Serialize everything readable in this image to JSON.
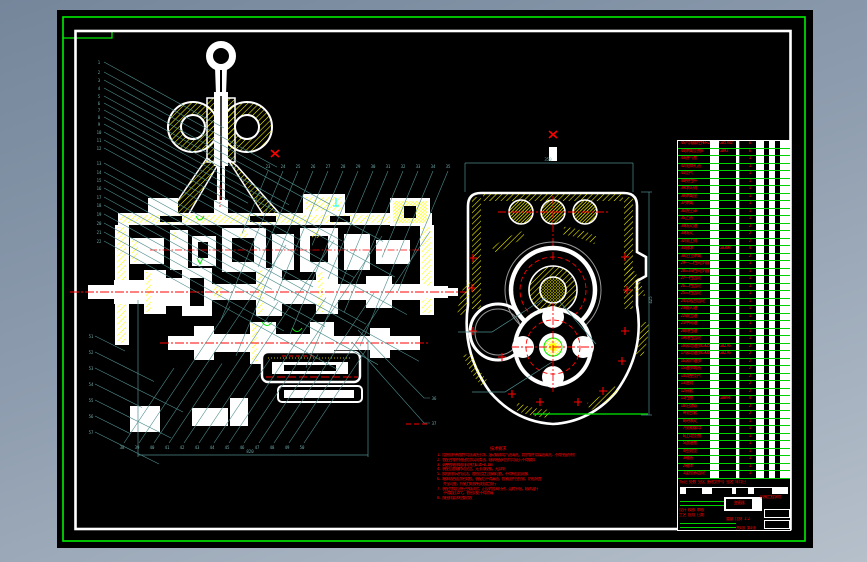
{
  "window": {
    "app": "CAD drawing viewport"
  },
  "colors": {
    "canvas": "#000000",
    "frame_green": "#00ff00",
    "sheet_white": "#ffffff",
    "hatch_yellow": "#ffff00",
    "centerline_red": "#ff0000",
    "leader_teal": "#4f8d8d",
    "table_green": "#00d200",
    "text_red": "#ff0000",
    "margin_gray": "#8d9cae"
  },
  "balloons": {
    "left": [
      "1",
      "2",
      "3",
      "4",
      "5",
      "6",
      "7",
      "8",
      "9",
      "10",
      "11",
      "12",
      "13",
      "14",
      "15",
      "16",
      "17",
      "18",
      "19",
      "20",
      "21",
      "22"
    ],
    "top": [
      "23",
      "24",
      "25",
      "26",
      "27",
      "28",
      "29",
      "30",
      "31",
      "32",
      "33",
      "34",
      "35"
    ],
    "right": [
      "36",
      "37"
    ],
    "bottom": [
      "38",
      "39",
      "40",
      "41",
      "42",
      "43",
      "44",
      "45",
      "46",
      "47",
      "48",
      "49",
      "50"
    ],
    "left_lower": [
      "51",
      "52",
      "53",
      "54",
      "55",
      "56",
      "57"
    ]
  },
  "dimensions": {
    "overall": "820",
    "top_width": "350",
    "side_height": "425"
  },
  "notes": {
    "title": "技术要求",
    "items": [
      {
        "text": "1. 组装前所有零件均须清洗干净，滚动轴承用汽油清洗，其余零件用煤油清洗，不得残留杂物",
        "indent": false
      },
      {
        "text": "2. 各配合零件装配前涂以润滑油，轴承装配时应均匀敲入不得偏斜",
        "indent": false
      },
      {
        "text": "3. 调整各轴承轴向间隙为0.05~0.1mm",
        "indent": false
      },
      {
        "text": "4. 装配后各轴转动灵活，无卡滞现象，无异响",
        "indent": false
      },
      {
        "text": "5. 换挡机构动作灵活，各档位定位准确可靠，不得有乱档现象",
        "indent": false
      },
      {
        "text": "6. 箱体结合面涂密封胶，装配后不得漏油，各紧固件应拧紧，防松装置",
        "indent": false
      },
      {
        "text": "齐全可靠，拧紧力矩按有关规定执行",
        "indent": true
      },
      {
        "text": "7. 装配完成后进行空载试验，正反转各30分钟，运转平稳，轴承温升",
        "indent": false
      },
      {
        "text": "不得超过35℃，各密封处不得渗漏",
        "indent": true
      },
      {
        "text": "8. 按图样要求检查验收",
        "indent": false
      }
    ]
  },
  "bom": {
    "rows": [
      {
        "no": "45",
        "name": "六角螺栓M8×25",
        "code": "GB5782",
        "qty": "6"
      },
      {
        "no": "44",
        "name": "弹簧垫圈8",
        "code": "GB93",
        "qty": "6"
      },
      {
        "no": "43",
        "name": "通气塞",
        "code": "",
        "qty": "1"
      },
      {
        "no": "42",
        "name": "观察孔盖",
        "code": "",
        "qty": "1"
      },
      {
        "no": "41",
        "name": "垫片",
        "code": "",
        "qty": "1"
      },
      {
        "no": "40",
        "name": "换挡杆",
        "code": "",
        "qty": "1"
      },
      {
        "no": "39",
        "name": "球头销",
        "code": "",
        "qty": "1"
      },
      {
        "no": "38",
        "name": "弹簧座",
        "code": "",
        "qty": "1"
      },
      {
        "no": "37",
        "name": "弹簧",
        "code": "",
        "qty": "1"
      },
      {
        "no": "36",
        "name": "防尘罩",
        "code": "",
        "qty": "1"
      },
      {
        "no": "35",
        "name": "上盖",
        "code": "",
        "qty": "1"
      },
      {
        "no": "34",
        "name": "拨叉轴",
        "code": "",
        "qty": "2"
      },
      {
        "no": "33",
        "name": "拨叉",
        "code": "",
        "qty": "2"
      },
      {
        "no": "32",
        "name": "锁止销",
        "code": "",
        "qty": "2"
      },
      {
        "no": "31",
        "name": "钢球",
        "code": "GB308",
        "qty": "4"
      },
      {
        "no": "30",
        "name": "定位弹簧",
        "code": "",
        "qty": "2"
      },
      {
        "no": "29",
        "name": "一二档同步器",
        "code": "",
        "qty": "1"
      },
      {
        "no": "28",
        "name": "三四档同步器",
        "code": "",
        "qty": "1"
      },
      {
        "no": "27",
        "name": "一档齿轮",
        "code": "",
        "qty": "1"
      },
      {
        "no": "26",
        "name": "二档齿轮",
        "code": "",
        "qty": "1"
      },
      {
        "no": "25",
        "name": "三档齿轮",
        "code": "",
        "qty": "1"
      },
      {
        "no": "24",
        "name": "常啮合齿轮",
        "code": "",
        "qty": "1"
      },
      {
        "no": "23",
        "name": "输入轴",
        "code": "",
        "qty": "1"
      },
      {
        "no": "22",
        "name": "输出轴",
        "code": "",
        "qty": "1"
      },
      {
        "no": "21",
        "name": "中间轴",
        "code": "",
        "qty": "1"
      },
      {
        "no": "20",
        "name": "倒档轴",
        "code": "",
        "qty": "1"
      },
      {
        "no": "19",
        "name": "倒档齿轮",
        "code": "",
        "qty": "1"
      },
      {
        "no": "18",
        "name": "滚动轴承6305",
        "code": "GB276",
        "qty": "2"
      },
      {
        "no": "17",
        "name": "滚动轴承6306",
        "code": "GB276",
        "qty": "2"
      },
      {
        "no": "16",
        "name": "滚针轴承",
        "code": "",
        "qty": "2"
      },
      {
        "no": "15",
        "name": "轴承端盖",
        "code": "",
        "qty": "2"
      },
      {
        "no": "14",
        "name": "调整垫片",
        "code": "",
        "qty": "2"
      },
      {
        "no": "13",
        "name": "油封",
        "code": "",
        "qty": "2"
      },
      {
        "no": "12",
        "name": "隔套",
        "code": "",
        "qty": "2"
      },
      {
        "no": "11",
        "name": "挡圈",
        "code": "GB894",
        "qty": "4"
      },
      {
        "no": "10",
        "name": "花键毂",
        "code": "",
        "qty": "2"
      },
      {
        "no": "9",
        "name": "接合套",
        "code": "",
        "qty": "2"
      },
      {
        "no": "8",
        "name": "突缘叉",
        "code": "",
        "qty": "1"
      },
      {
        "no": "7",
        "name": "锁紧螺母",
        "code": "",
        "qty": "1"
      },
      {
        "no": "6",
        "name": "止动垫圈",
        "code": "",
        "qty": "1"
      },
      {
        "no": "5",
        "name": "放油塞",
        "code": "",
        "qty": "1"
      },
      {
        "no": "4",
        "name": "密封垫",
        "code": "",
        "qty": "1"
      },
      {
        "no": "3",
        "name": "箱盖",
        "code": "",
        "qty": "1"
      },
      {
        "no": "2",
        "name": "箱体",
        "code": "",
        "qty": "1"
      },
      {
        "no": "1",
        "name": "里程表齿轮",
        "code": "",
        "qty": "1"
      }
    ]
  },
  "title_block": {
    "rev_row": "标记 处数 分区 更改文件号 签名 年月日",
    "sign_row1": "设计  校核  审核",
    "sign_row2": "工艺  批准  日期",
    "drawing_name": "变速器",
    "school": "机械工程学院",
    "weight_scale": "重量  比例 1:2",
    "sheet": "共1张 第1张"
  }
}
